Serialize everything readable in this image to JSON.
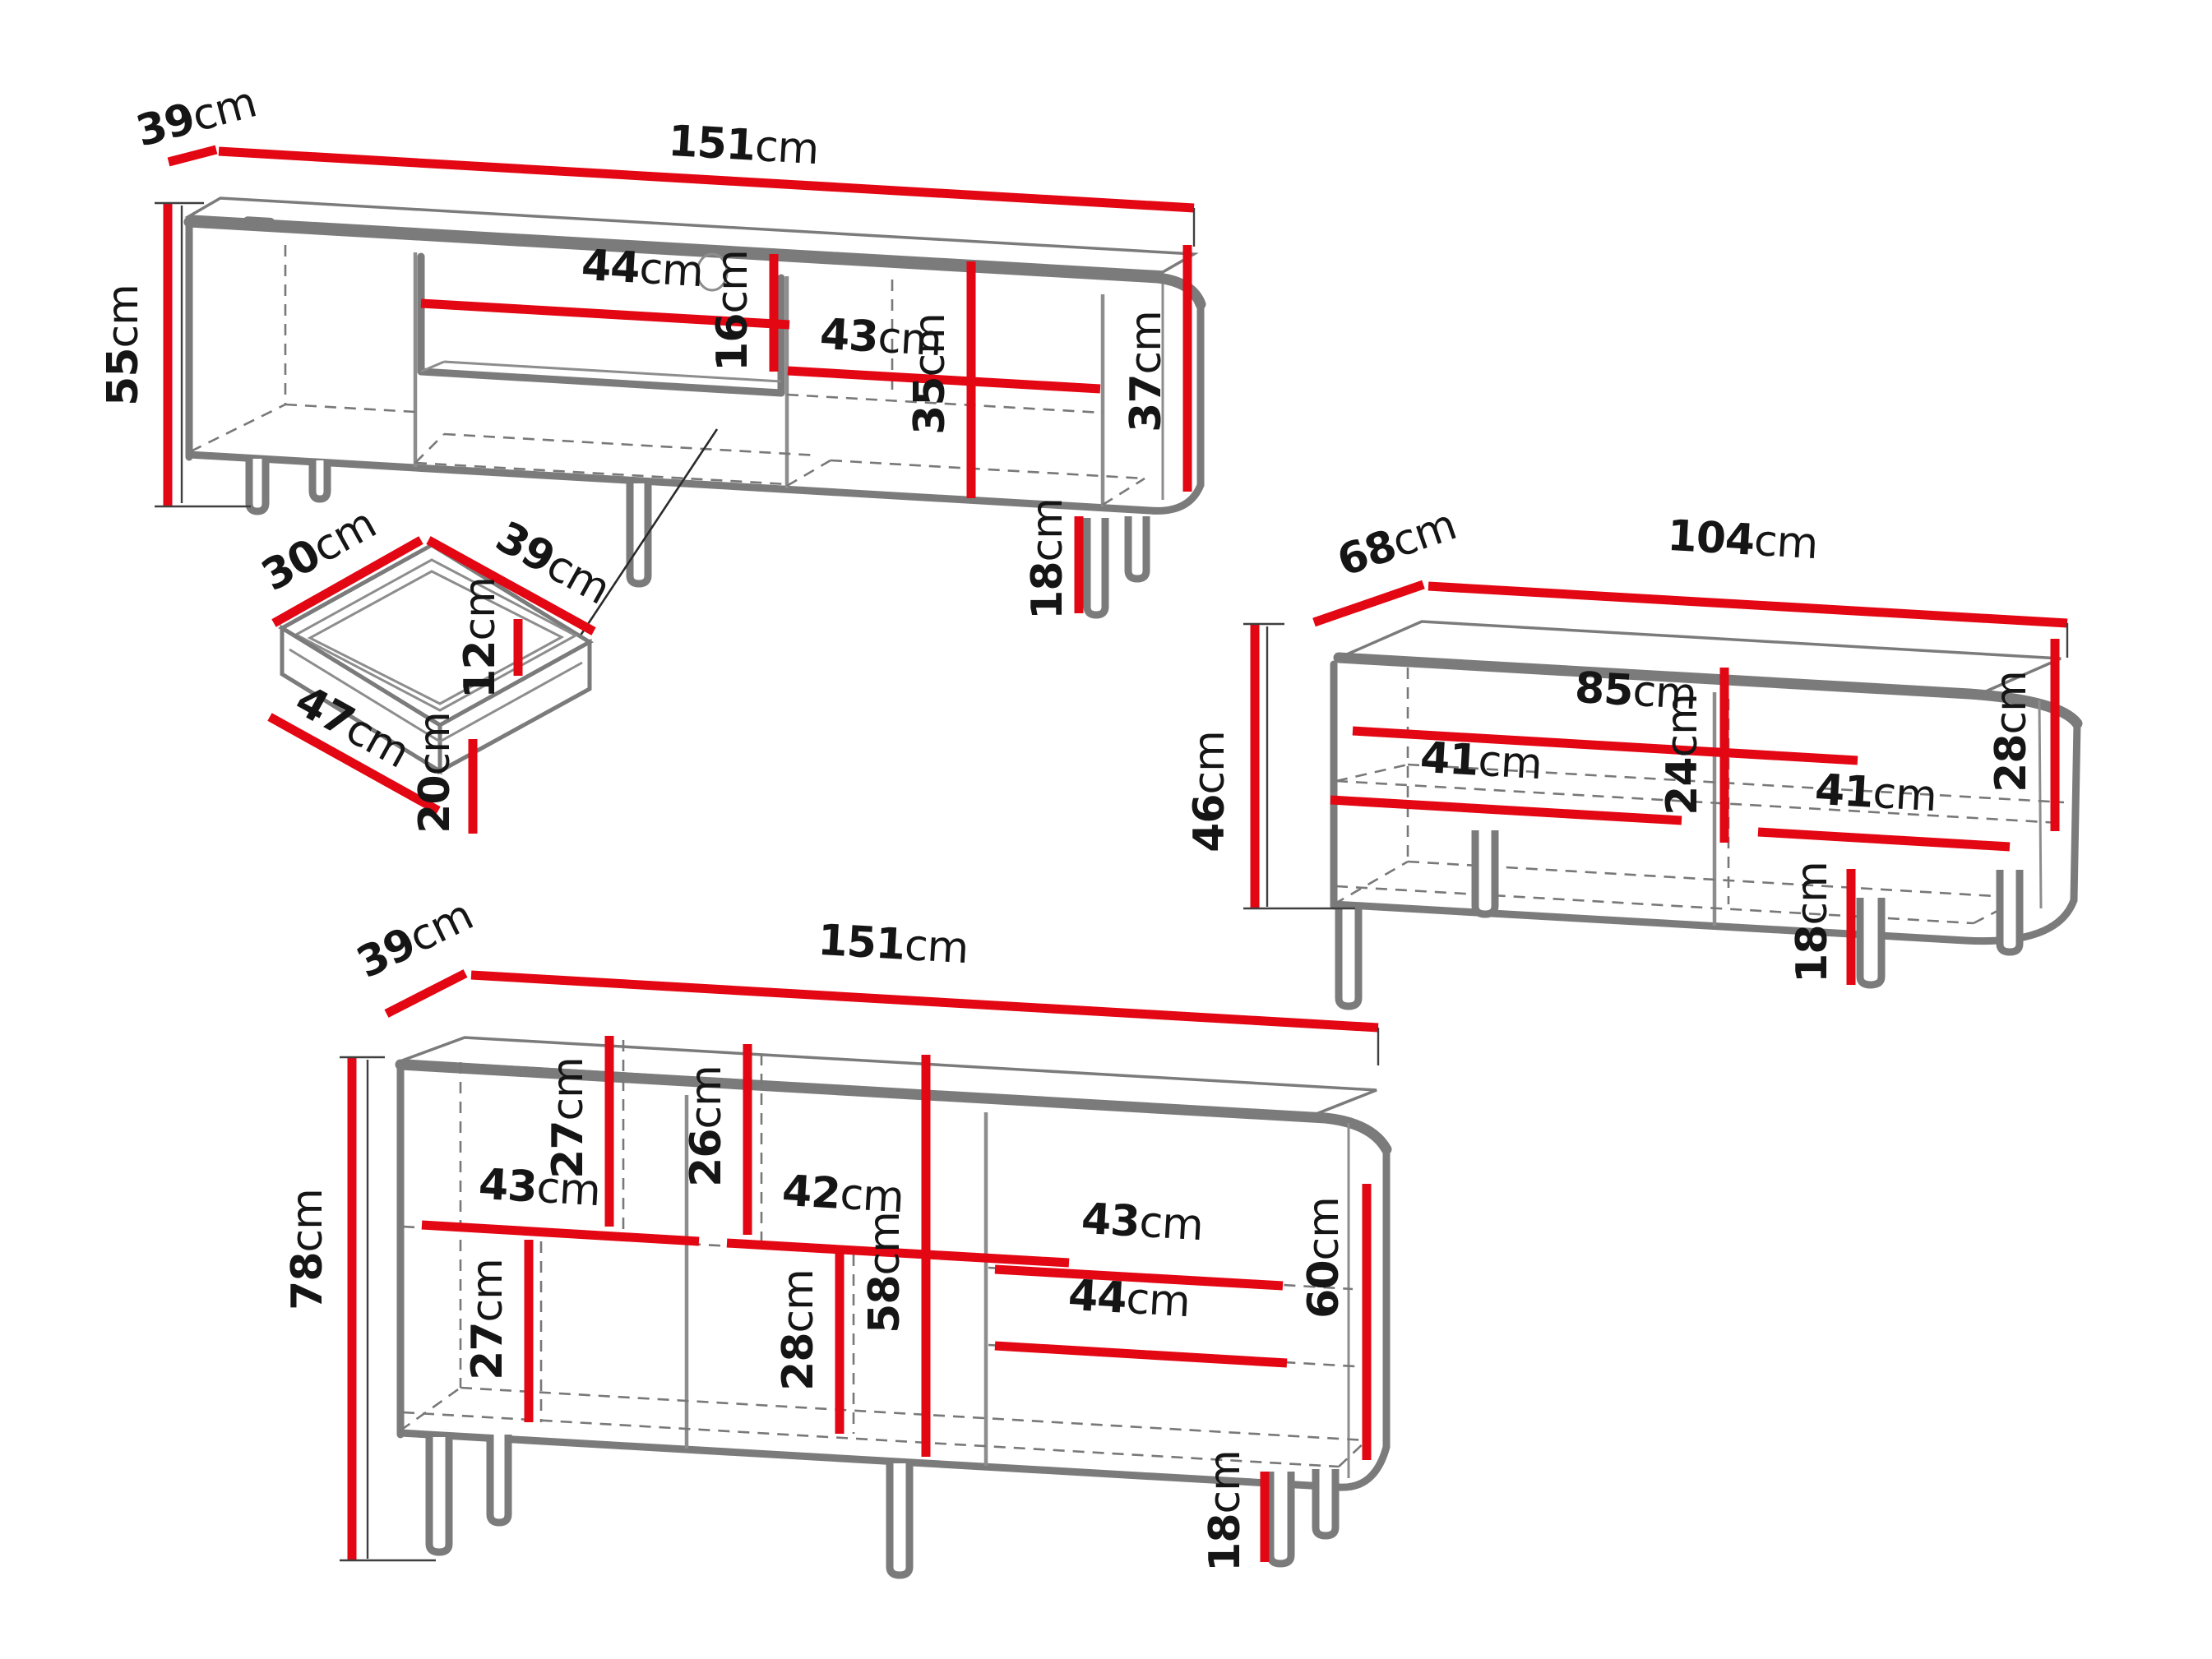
{
  "title": "Furniture set dimension diagram",
  "colors": {
    "dimension_red": "#e30613",
    "outline_gray": "#7b7b7b",
    "hidden_edge_gray": "#787878",
    "label_black": "#151515",
    "background": "#ffffff"
  },
  "pieces": {
    "tv_stand": {
      "name": "tv-stand",
      "dims": {
        "depth": {
          "v": "39",
          "u": "cm"
        },
        "width": {
          "v": "151",
          "u": "cm"
        },
        "height": {
          "v": "55",
          "u": "cm"
        },
        "niche_width": {
          "v": "44",
          "u": "cm"
        },
        "niche_height": {
          "v": "16",
          "u": "cm"
        },
        "right_width": {
          "v": "43",
          "u": "cm"
        },
        "right_height": {
          "v": "35",
          "u": "cm"
        },
        "body_height": {
          "v": "37",
          "u": "cm"
        },
        "leg_height": {
          "v": "18",
          "u": "cm"
        }
      }
    },
    "drawer": {
      "name": "drawer-detail",
      "dims": {
        "inner_depth": {
          "v": "30",
          "u": "cm"
        },
        "inner_width": {
          "v": "39",
          "u": "cm"
        },
        "inner_height": {
          "v": "12",
          "u": "cm"
        },
        "front_width": {
          "v": "47",
          "u": "cm"
        },
        "front_height": {
          "v": "20",
          "u": "cm"
        }
      }
    },
    "coffee_table": {
      "name": "coffee-table",
      "dims": {
        "depth": {
          "v": "68",
          "u": "cm"
        },
        "width": {
          "v": "104",
          "u": "cm"
        },
        "height": {
          "v": "46",
          "u": "cm"
        },
        "inner_width": {
          "v": "85",
          "u": "cm"
        },
        "inner_height": {
          "v": "24",
          "u": "cm"
        },
        "left_shelf": {
          "v": "41",
          "u": "cm"
        },
        "right_shelf": {
          "v": "41",
          "u": "cm"
        },
        "side_height": {
          "v": "28",
          "u": "cm"
        },
        "leg_height": {
          "v": "18",
          "u": "cm"
        }
      }
    },
    "sideboard": {
      "name": "sideboard",
      "dims": {
        "depth": {
          "v": "39",
          "u": "cm"
        },
        "width": {
          "v": "151",
          "u": "cm"
        },
        "height": {
          "v": "78",
          "u": "cm"
        },
        "left_upper_height": {
          "v": "27",
          "u": "cm"
        },
        "middle_upper_height": {
          "v": "26",
          "u": "cm"
        },
        "left_shelf_width": {
          "v": "43",
          "u": "cm"
        },
        "middle_shelf_width": {
          "v": "42",
          "u": "cm"
        },
        "right_upper_width": {
          "v": "43",
          "u": "cm"
        },
        "left_lower_height": {
          "v": "27",
          "u": "cm"
        },
        "middle_lower_height": {
          "v": "28",
          "u": "cm"
        },
        "middle_full_height": {
          "v": "58",
          "u": "cm"
        },
        "right_lower_width": {
          "v": "44",
          "u": "cm"
        },
        "right_inner_height": {
          "v": "60",
          "u": "cm"
        },
        "leg_height": {
          "v": "18",
          "u": "cm"
        }
      }
    }
  }
}
